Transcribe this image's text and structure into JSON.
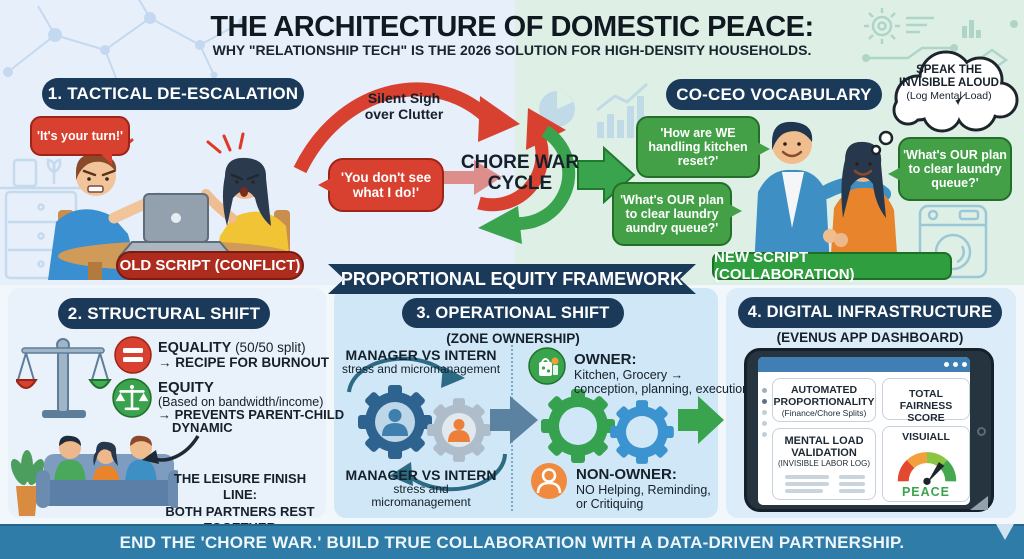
{
  "header": {
    "title": "THE ARCHITECTURE OF DOMESTIC PEACE:",
    "subtitle": "WHY \"RELATIONSHIP TECH\" IS THE 2026 SOLUTION FOR HIGH-DENSITY HOUSEHOLDS."
  },
  "tactical": {
    "header": "1. TACTICAL DE-ESCALATION",
    "bubble_turn": "'It's your turn!'",
    "bubble_see": [
      "'You don't see",
      "what I do!'"
    ],
    "old_script": "OLD SCRIPT (CONFLICT)"
  },
  "cycle": {
    "annotation": [
      "Silent Sigh",
      "over Clutter"
    ],
    "label": [
      "CHORE WAR",
      "CYCLE"
    ]
  },
  "coceo": {
    "header": "CO-CEO VOCABULARY",
    "cloud": [
      "SPEAK THE",
      "INVISIBLE ALOUD",
      "(Log Mental Load)"
    ],
    "bubble_kitchen": [
      "'How are WE",
      "handling kitchen",
      "reset?'"
    ],
    "bubble_laundry_left": [
      "'What's OUR plan",
      "to clear laundry",
      "aundry queue?'"
    ],
    "bubble_laundry_right": [
      "'What's OUR plan",
      "to clear laundry",
      "queue?'"
    ],
    "new_script": "NEW SCRIPT (COLLABORATION)"
  },
  "ribbon": "PROPORTIONAL EQUITY FRAMEWORK",
  "structural": {
    "header": "2. STRUCTURAL SHIFT",
    "equality_title": "EQUALITY",
    "equality_suffix": " (50/50 split)",
    "equality_result": "→ RECIPE FOR BURNOUT",
    "equity_title": "EQUITY",
    "equity_basis": "(Based on bandwidth/income)",
    "equity_result_1": "→ PREVENTS PARENT-CHILD",
    "equity_result_2": "DYNAMIC",
    "leisure": [
      "THE LEISURE FINISH LINE:",
      "BOTH PARTNERS REST",
      "TOGETHER"
    ]
  },
  "operational": {
    "header": "3. OPERATIONAL SHIFT",
    "subheader": "(ZONE OWNERSHIP)",
    "manager_top": [
      "MANAGER VS INTERN",
      "stress and micromanagement"
    ],
    "manager_bottom": [
      "MANAGER VS INTERN",
      "stress and",
      "micromanagement"
    ],
    "owner_title": "OWNER:",
    "owner_lines": [
      "Kitchen, Grocery →",
      "conception, planning, execution"
    ],
    "nonowner_title": "NON-OWNER:",
    "nonowner_lines": [
      "NO Helping, Reminding,",
      "or Critiquing"
    ]
  },
  "digital": {
    "header": "4. DIGITAL INFRASTRUCTURE",
    "subheader": "(EVENUS APP DASHBOARD)",
    "card_auto": [
      "AUTOMATED",
      "PROPORTIONALITY"
    ],
    "card_auto_sub": "(Finance/Chore Splits)",
    "card_fairness": [
      "TOTAL FAIRNESS",
      "SCORE"
    ],
    "card_mental": [
      "MENTAL LOAD",
      "VALIDATION"
    ],
    "card_mental_sub": "(INVISIBLE LABOR LOG)",
    "visual_title": "VISUIALL",
    "visual_value": "PEACE"
  },
  "footer": "END THE 'CHORE WAR.' BUILD TRUE COLLABORATION WITH A DATA-DRIVEN PARTNERSHIP.",
  "colors": {
    "navy": "#1b3a5a",
    "red": "#d8402f",
    "green": "#3fa34d",
    "footer_blue": "#2e7ca7"
  }
}
